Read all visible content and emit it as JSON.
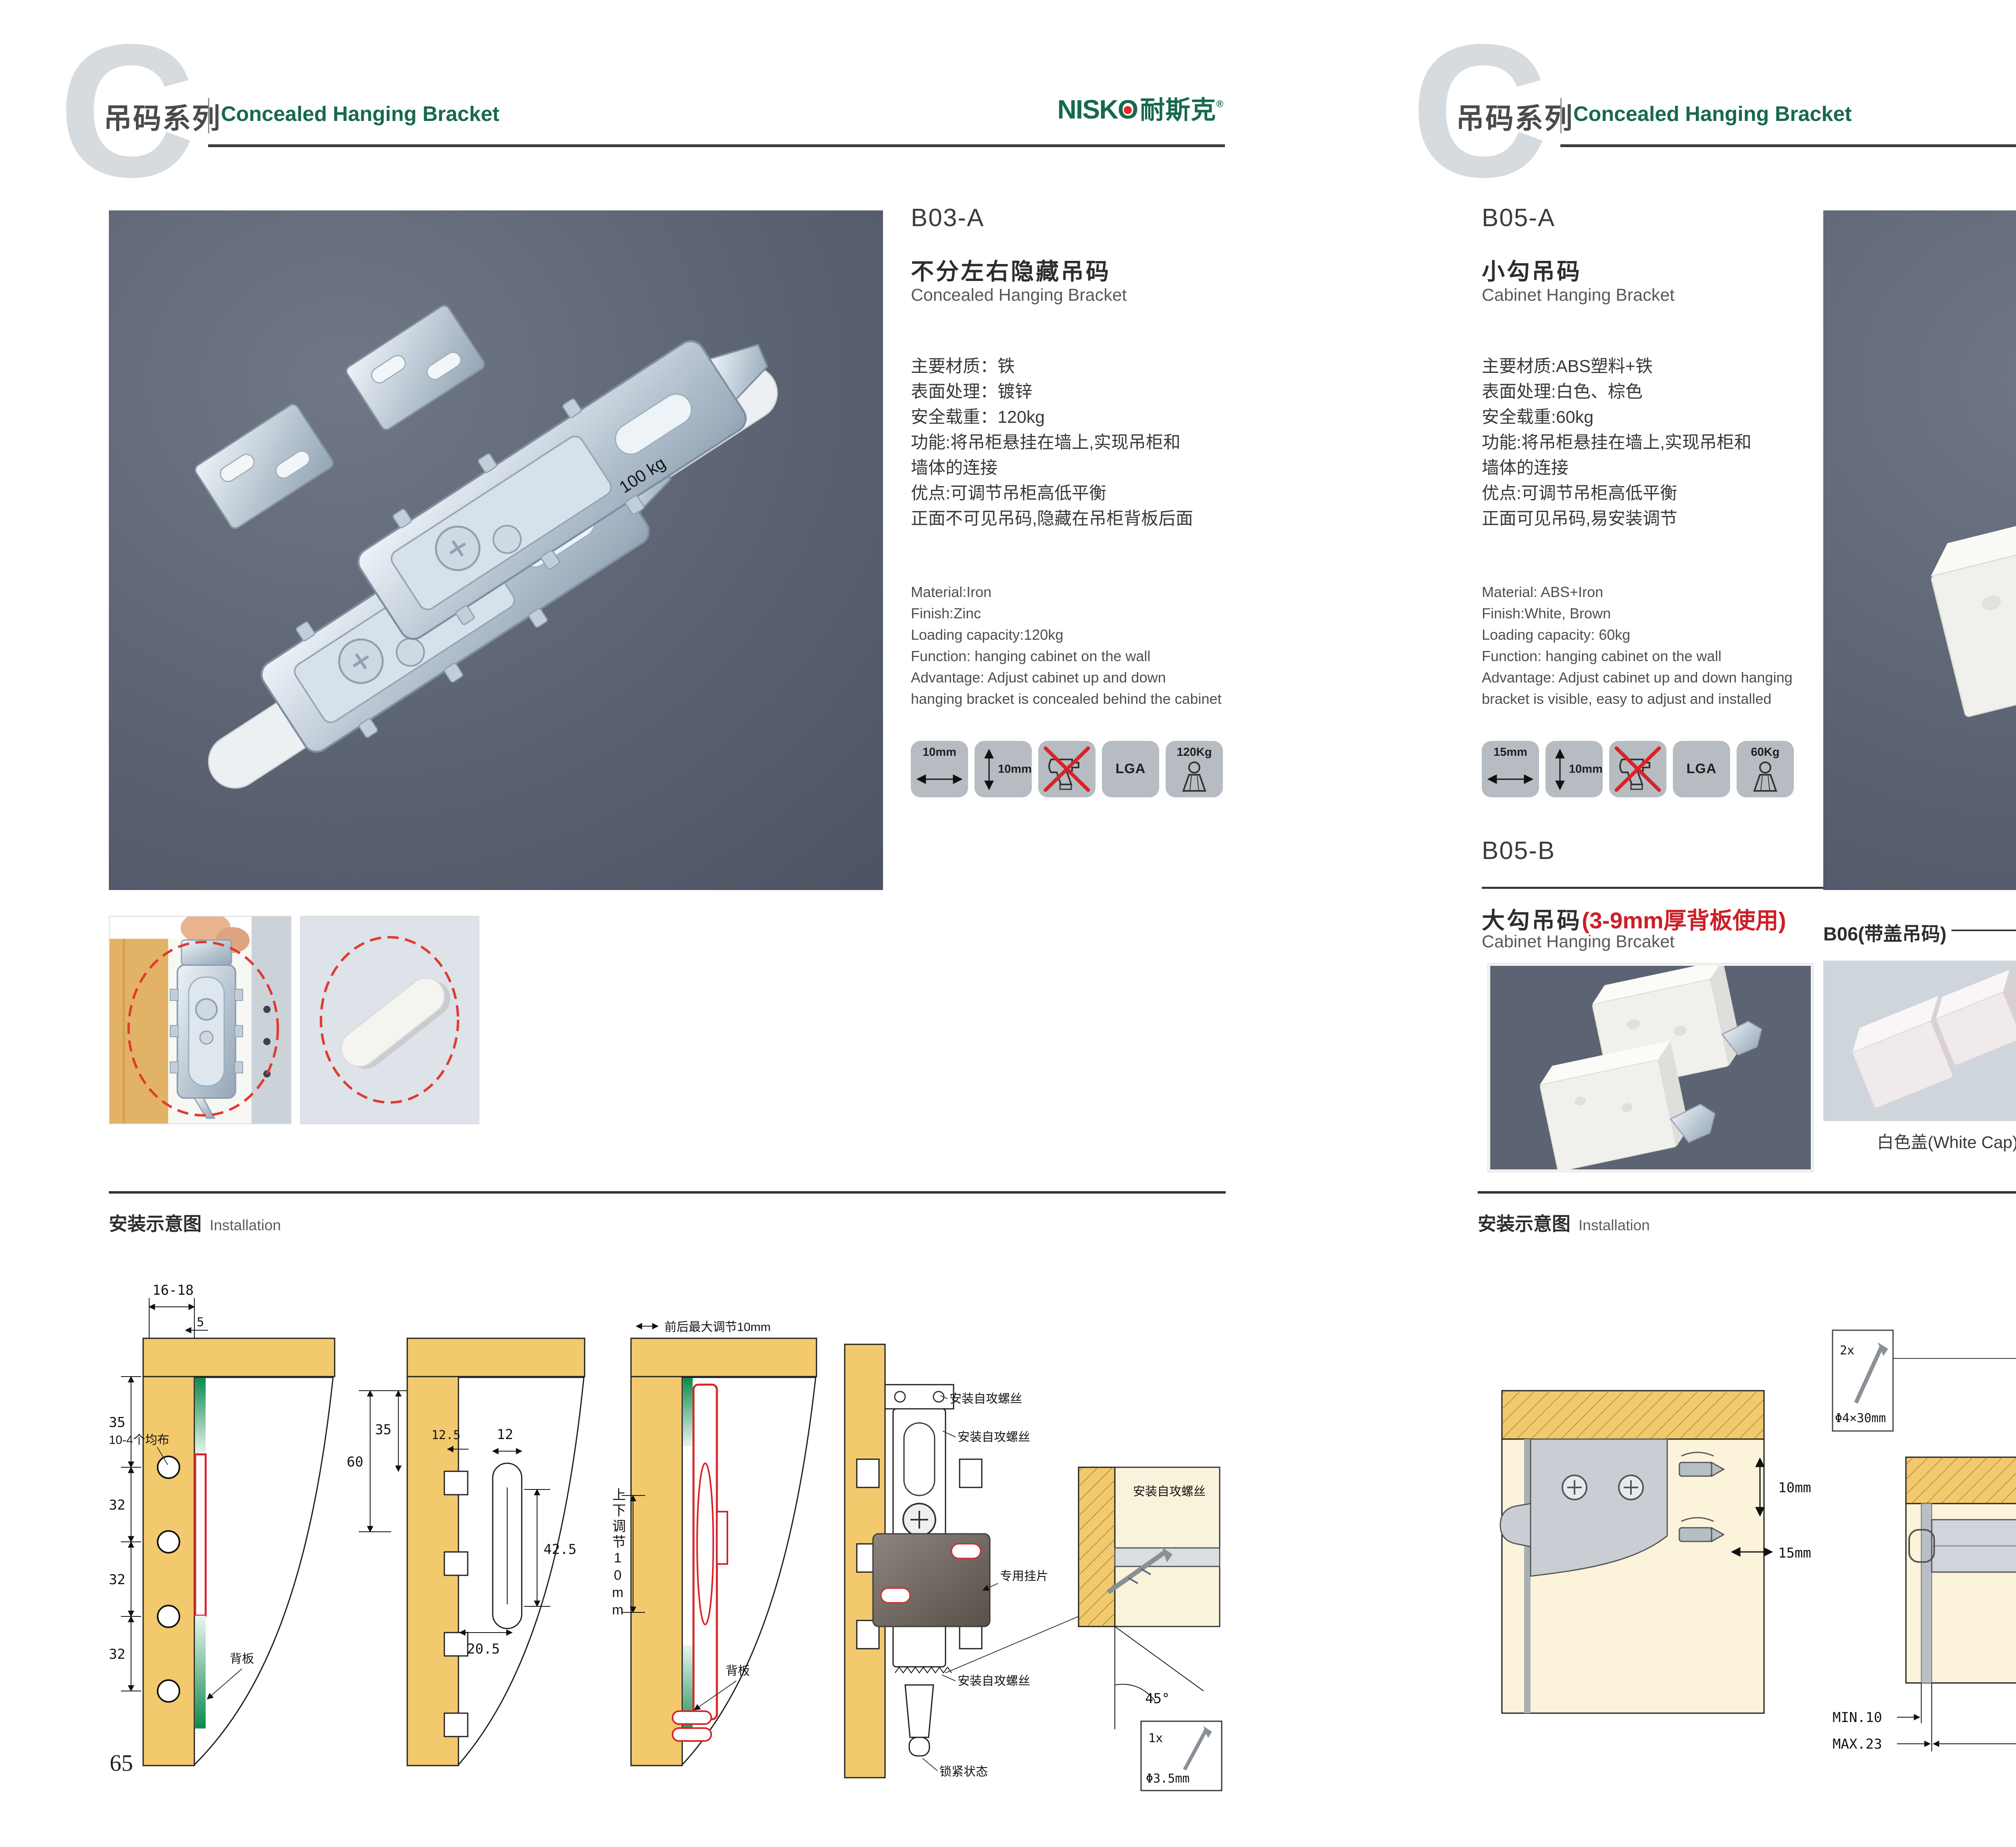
{
  "brand": {
    "logo_part1": "NISK",
    "logo_o": "O",
    "logo_cn": "耐斯克",
    "logo_reg": "®",
    "green": "#17694d",
    "red": "#e8262d"
  },
  "header": {
    "series_letter": "C",
    "series_zh": "吊码系列",
    "series_en": "Concealed Hanging Bracket"
  },
  "installation": {
    "zh": "安装示意图",
    "en": "Installation"
  },
  "pages": {
    "left": {
      "number": "65",
      "product": {
        "code": "B03-A",
        "name_zh": "不分左右隐藏吊码",
        "name_en": "Concealed Hanging Bracket",
        "specs_zh": [
          "主要材质：铁",
          "表面处理：镀锌",
          "安全载重：120kg",
          "功能:将吊柜悬挂在墙上,实现吊柜和",
          "墙体的连接",
          "优点:可调节吊柜高低平衡",
          "正面不可见吊码,隐藏在吊柜背板后面"
        ],
        "specs_en": [
          "Material:Iron",
          "Finish:Zinc",
          "Loading capacity:120kg",
          "Function: hanging cabinet on the wall",
          "Advantage: Adjust cabinet up and down",
          "hanging bracket is concealed behind the cabinet"
        ],
        "icons": [
          {
            "label": "10mm",
            "type": "width-arrow"
          },
          {
            "label": "10mm",
            "type": "height-arrow"
          },
          {
            "label": "",
            "type": "no-drill"
          },
          {
            "label": "LGA",
            "type": "certificate"
          },
          {
            "label": "120Kg",
            "type": "load"
          }
        ]
      },
      "photo_mark": "100 kg",
      "diagrams": {
        "d1": {
          "top": "16-18",
          "offset": "5",
          "dims": [
            "35",
            "32",
            "32",
            "32"
          ],
          "holes": "10-4个均布",
          "back": "背板"
        },
        "d2": {
          "d60": "60",
          "d35": "35",
          "d125": "12.5",
          "d12": "12",
          "d425": "42.5",
          "d205": "20.5"
        },
        "d3": {
          "top": "前后最大调节10mm",
          "side": "上下调节10mm",
          "back": "背板"
        },
        "d4": {
          "screw": "安装自攻螺丝",
          "plate": "专用挂片",
          "lock": "锁紧状态",
          "angle": "45°",
          "qty": "1x",
          "dia": "Φ3.5mm"
        }
      }
    },
    "right": {
      "number": "66",
      "product_a": {
        "code": "B05-A",
        "name_zh": "小勾吊码",
        "name_en": "Cabinet Hanging Bracket",
        "specs_zh": [
          "主要材质:ABS塑料+铁",
          "表面处理:白色、棕色",
          "安全载重:60kg",
          "功能:将吊柜悬挂在墙上,实现吊柜和",
          "墙体的连接",
          "优点:可调节吊柜高低平衡",
          "正面可见吊码,易安装调节"
        ],
        "specs_en": [
          "Material: ABS+Iron",
          "Finish:White, Brown",
          "Loading capacity: 60kg",
          "Function: hanging cabinet on the wall",
          "Advantage: Adjust cabinet up and down hanging",
          "bracket is visible, easy to adjust and installed"
        ],
        "icons": [
          {
            "label": "15mm",
            "type": "width-arrow"
          },
          {
            "label": "10mm",
            "type": "height-arrow"
          },
          {
            "label": "",
            "type": "no-drill"
          },
          {
            "label": "LGA",
            "type": "certificate"
          },
          {
            "label": "60Kg",
            "type": "load"
          }
        ]
      },
      "product_b": {
        "code": "B05-B",
        "name_zh": "大勾吊码",
        "note": "(3-9mm厚背板使用)",
        "name_en": "Cabinet Hanging Brcaket"
      },
      "b06": {
        "title": "B06(带盖吊码)",
        "caps": [
          "白色盖(White Cap)",
          "灰色盖(Gray Cap)",
          "银色盖(Silver Cap)"
        ]
      },
      "diagrams": {
        "da": {
          "v": "10mm",
          "h": "15mm"
        },
        "db": {
          "qty": "2x",
          "size": "Φ4×30mm",
          "h18": "18",
          "min": "MIN.10",
          "max": "MAX.23",
          "w58": "58"
        },
        "dc": {
          "d16a": "16",
          "d42": "42",
          "rmax": "RMAX4",
          "d16b": "16",
          "d17": "17",
          "d32": "32"
        }
      }
    }
  }
}
